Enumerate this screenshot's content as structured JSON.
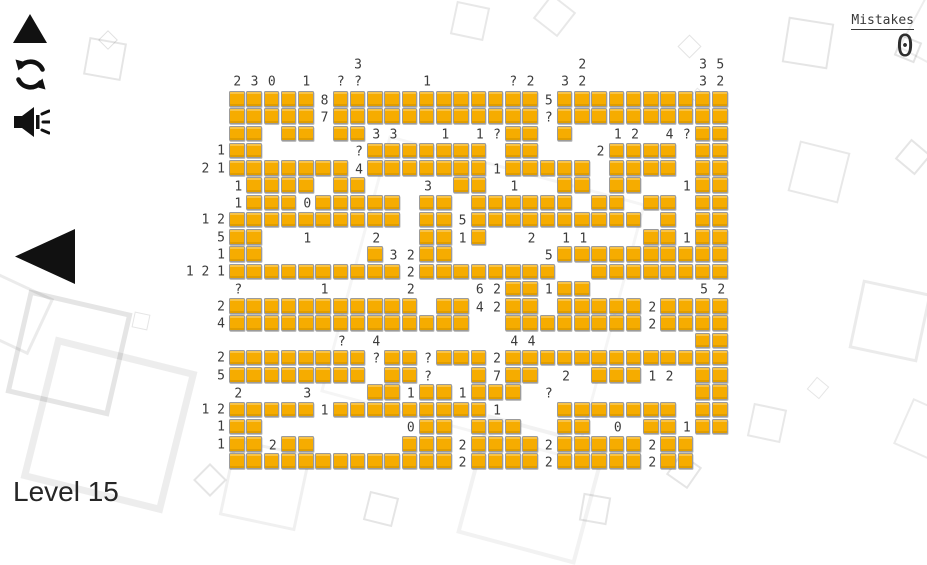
{
  "header": {
    "mistakes_label": "Mistakes",
    "mistakes_value": "0"
  },
  "footer": {
    "level_label": "Level 15"
  },
  "controls": {
    "up_button": "up-triangle",
    "restart_button": "refresh-arrows",
    "sound_button": "speaker-waves",
    "back_button": "left-triangle"
  },
  "colors": {
    "tile_fill": "#F6AC00",
    "tile_border": "#9B9B9B",
    "icon_black": "#111111",
    "label_gray": "#3C3C3C"
  },
  "puzzle": {
    "rows": 22,
    "cols": 29,
    "geometry": {
      "left": 229,
      "top": 91,
      "pitch": 17.25,
      "tile": 15.5
    },
    "grid": [
      "#####.############.##########",
      "#####.############.##########",
      "##.##.##........##.#.......##",
      "##......#######.##....####.##",
      "#######.#######.#####.####.##",
      ".####.##.....##....##.##...##",
      ".###.#####.##.######.##.##.##",
      "##########.##.##########.#.##",
      "##.........##.#.........##.##",
      "##......#..##......##########",
      "##########.########..########",
      "................##.##........",
      "###########.##..##.#####.####",
      "##############..########.####",
      "...........................##",
      "########.##.###.#############",
      "########.##...#.##...###...##",
      "........##.##.###..........##",
      "#####.#########....#######.##",
      "##.........##.###..##...##.##",
      "##.##.....###.####.#####.##..",
      "#############.####.#####.##.."
    ],
    "cell_labels": [
      {
        "r": 0,
        "c": 5,
        "t": "8"
      },
      {
        "r": 0,
        "c": 18,
        "t": "5"
      },
      {
        "r": 1,
        "c": 5,
        "t": "7"
      },
      {
        "r": 1,
        "c": 18,
        "t": "?"
      },
      {
        "r": 2,
        "c": 8,
        "t": "3"
      },
      {
        "r": 2,
        "c": 9,
        "t": "3"
      },
      {
        "r": 2,
        "c": 12,
        "t": "1"
      },
      {
        "r": 2,
        "c": 14,
        "t": "1"
      },
      {
        "r": 2,
        "c": 15,
        "t": "?"
      },
      {
        "r": 2,
        "c": 22,
        "t": "1"
      },
      {
        "r": 2,
        "c": 23,
        "t": "2"
      },
      {
        "r": 2,
        "c": 25,
        "t": "4"
      },
      {
        "r": 2,
        "c": 26,
        "t": "?"
      },
      {
        "r": 3,
        "c": 7,
        "t": "?"
      },
      {
        "r": 3,
        "c": 21,
        "t": "2"
      },
      {
        "r": 4,
        "c": 7,
        "t": "4"
      },
      {
        "r": 4,
        "c": 15,
        "t": "1"
      },
      {
        "r": 5,
        "c": 0,
        "t": "1"
      },
      {
        "r": 5,
        "c": 11,
        "t": "3"
      },
      {
        "r": 5,
        "c": 16,
        "t": "1"
      },
      {
        "r": 5,
        "c": 26,
        "t": "1"
      },
      {
        "r": 6,
        "c": 0,
        "t": "1"
      },
      {
        "r": 6,
        "c": 4,
        "t": "0"
      },
      {
        "r": 7,
        "c": 13,
        "t": "5"
      },
      {
        "r": 8,
        "c": 4,
        "t": "1"
      },
      {
        "r": 8,
        "c": 8,
        "t": "2"
      },
      {
        "r": 8,
        "c": 13,
        "t": "1"
      },
      {
        "r": 8,
        "c": 17,
        "t": "2"
      },
      {
        "r": 8,
        "c": 19,
        "t": "1"
      },
      {
        "r": 8,
        "c": 20,
        "t": "1"
      },
      {
        "r": 8,
        "c": 26,
        "t": "1"
      },
      {
        "r": 9,
        "c": 9,
        "t": "3"
      },
      {
        "r": 9,
        "c": 10,
        "t": "2"
      },
      {
        "r": 9,
        "c": 18,
        "t": "5"
      },
      {
        "r": 10,
        "c": 10,
        "t": "2"
      },
      {
        "r": 11,
        "c": 0,
        "t": "?"
      },
      {
        "r": 11,
        "c": 5,
        "t": "1"
      },
      {
        "r": 11,
        "c": 10,
        "t": "2"
      },
      {
        "r": 11,
        "c": 14,
        "t": "6"
      },
      {
        "r": 11,
        "c": 15,
        "t": "2"
      },
      {
        "r": 11,
        "c": 18,
        "t": "1"
      },
      {
        "r": 11,
        "c": 27,
        "t": "5"
      },
      {
        "r": 11,
        "c": 28,
        "t": "2"
      },
      {
        "r": 12,
        "c": 14,
        "t": "4"
      },
      {
        "r": 12,
        "c": 15,
        "t": "2"
      },
      {
        "r": 12,
        "c": 24,
        "t": "2"
      },
      {
        "r": 13,
        "c": 24,
        "t": "2"
      },
      {
        "r": 14,
        "c": 6,
        "t": "?"
      },
      {
        "r": 14,
        "c": 8,
        "t": "4"
      },
      {
        "r": 14,
        "c": 16,
        "t": "4"
      },
      {
        "r": 14,
        "c": 17,
        "t": "4"
      },
      {
        "r": 15,
        "c": 8,
        "t": "?"
      },
      {
        "r": 15,
        "c": 11,
        "t": "?"
      },
      {
        "r": 15,
        "c": 15,
        "t": "2"
      },
      {
        "r": 16,
        "c": 11,
        "t": "?"
      },
      {
        "r": 16,
        "c": 15,
        "t": "7"
      },
      {
        "r": 16,
        "c": 19,
        "t": "2"
      },
      {
        "r": 16,
        "c": 24,
        "t": "1"
      },
      {
        "r": 16,
        "c": 25,
        "t": "2"
      },
      {
        "r": 17,
        "c": 0,
        "t": "2"
      },
      {
        "r": 17,
        "c": 4,
        "t": "3"
      },
      {
        "r": 17,
        "c": 10,
        "t": "1"
      },
      {
        "r": 17,
        "c": 13,
        "t": "1"
      },
      {
        "r": 17,
        "c": 18,
        "t": "?"
      },
      {
        "r": 18,
        "c": 5,
        "t": "1"
      },
      {
        "r": 18,
        "c": 15,
        "t": "1"
      },
      {
        "r": 19,
        "c": 10,
        "t": "0"
      },
      {
        "r": 19,
        "c": 22,
        "t": "0"
      },
      {
        "r": 19,
        "c": 26,
        "t": "1"
      },
      {
        "r": 20,
        "c": 2,
        "t": "2"
      },
      {
        "r": 20,
        "c": 13,
        "t": "2"
      },
      {
        "r": 20,
        "c": 18,
        "t": "2"
      },
      {
        "r": 20,
        "c": 24,
        "t": "2"
      },
      {
        "r": 21,
        "c": 13,
        "t": "2"
      },
      {
        "r": 21,
        "c": 18,
        "t": "2"
      },
      {
        "r": 21,
        "c": 24,
        "t": "2"
      }
    ],
    "left_labels": [
      {
        "r": 3,
        "t": "1"
      },
      {
        "r": 4,
        "t": "2 1"
      },
      {
        "r": 7,
        "t": "1 2"
      },
      {
        "r": 8,
        "t": "5"
      },
      {
        "r": 9,
        "t": "1"
      },
      {
        "r": 10,
        "t": "1 2 1"
      },
      {
        "r": 12,
        "t": "2"
      },
      {
        "r": 13,
        "t": "4"
      },
      {
        "r": 15,
        "t": "2"
      },
      {
        "r": 16,
        "t": "5"
      },
      {
        "r": 18,
        "t": "1 2"
      },
      {
        "r": 19,
        "t": "1"
      },
      {
        "r": 20,
        "t": "1"
      }
    ],
    "top_labels_lower": [
      {
        "c": 0,
        "t": "2"
      },
      {
        "c": 1,
        "t": "3"
      },
      {
        "c": 2,
        "t": "0"
      },
      {
        "c": 4,
        "t": "1"
      },
      {
        "c": 6,
        "t": "?"
      },
      {
        "c": 7,
        "t": "?"
      },
      {
        "c": 11,
        "t": "1"
      },
      {
        "c": 16,
        "t": "?"
      },
      {
        "c": 17,
        "t": "2"
      },
      {
        "c": 19,
        "t": "3"
      },
      {
        "c": 20,
        "t": "2"
      },
      {
        "c": 27,
        "t": "3"
      },
      {
        "c": 28,
        "t": "2"
      }
    ],
    "top_labels_upper": [
      {
        "c": 7,
        "t": "3"
      },
      {
        "c": 20,
        "t": "2"
      },
      {
        "c": 27,
        "t": "3"
      },
      {
        "c": 28,
        "t": "5"
      }
    ]
  },
  "decor_squares": [
    {
      "x": 86,
      "y": 40,
      "s": 34,
      "rot": 10,
      "w": 2,
      "o": 0.1
    },
    {
      "x": 101,
      "y": 33,
      "s": 12,
      "rot": 45,
      "w": 1.5,
      "o": 0.12
    },
    {
      "x": 453,
      "y": 4,
      "s": 30,
      "rot": 12,
      "w": 2,
      "o": 0.09
    },
    {
      "x": 539,
      "y": 0,
      "s": 27,
      "rot": 38,
      "w": 2,
      "o": 0.09
    },
    {
      "x": 681,
      "y": 38,
      "s": 15,
      "rot": 45,
      "w": 1.5,
      "o": 0.11
    },
    {
      "x": 785,
      "y": 20,
      "s": 42,
      "rot": 9,
      "w": 2.5,
      "o": 0.1
    },
    {
      "x": 897,
      "y": 38,
      "s": 18,
      "rot": 22,
      "w": 2,
      "o": 0.11
    },
    {
      "x": 920,
      "y": -40,
      "s": 120,
      "rot": 28,
      "w": 2,
      "o": 0.07
    },
    {
      "x": 692,
      "y": 90,
      "s": 10,
      "rot": 40,
      "w": 1,
      "o": 0.09
    },
    {
      "x": 793,
      "y": 146,
      "s": 48,
      "rot": 14,
      "w": 2.5,
      "o": 0.09
    },
    {
      "x": 900,
      "y": 144,
      "s": 22,
      "rot": 40,
      "w": 2,
      "o": 0.1
    },
    {
      "x": 855,
      "y": 286,
      "s": 64,
      "rot": 12,
      "w": 3,
      "o": 0.08
    },
    {
      "x": 901,
      "y": 406,
      "s": 46,
      "rot": 24,
      "w": 2.5,
      "o": 0.08
    },
    {
      "x": -18,
      "y": 283,
      "s": 56,
      "rot": 25,
      "w": 3,
      "o": 0.08
    },
    {
      "x": 16,
      "y": 300,
      "s": 96,
      "rot": 13,
      "w": 5,
      "o": 0.1
    },
    {
      "x": 133,
      "y": 313,
      "s": 14,
      "rot": 12,
      "w": 1.5,
      "o": 0.1
    },
    {
      "x": 36,
      "y": 352,
      "s": 132,
      "rot": 14,
      "w": 7,
      "o": 0.07
    },
    {
      "x": 198,
      "y": 468,
      "s": 20,
      "rot": 45,
      "w": 2,
      "o": 0.1
    },
    {
      "x": 226,
      "y": 446,
      "s": 72,
      "rot": 12,
      "w": 3,
      "o": 0.06
    },
    {
      "x": 366,
      "y": 494,
      "s": 26,
      "rot": 14,
      "w": 2,
      "o": 0.1
    },
    {
      "x": 581,
      "y": 495,
      "s": 24,
      "rot": 10,
      "w": 2,
      "o": 0.1
    },
    {
      "x": 671,
      "y": 458,
      "s": 22,
      "rot": 35,
      "w": 2,
      "o": 0.1
    },
    {
      "x": 750,
      "y": 406,
      "s": 30,
      "rot": 12,
      "w": 2,
      "o": 0.09
    },
    {
      "x": 810,
      "y": 380,
      "s": 14,
      "rot": 40,
      "w": 1.5,
      "o": 0.1
    },
    {
      "x": 470,
      "y": 428,
      "s": 115,
      "rot": 15,
      "w": 4,
      "o": 0.05
    },
    {
      "x": 350,
      "y": 165,
      "s": 260,
      "rot": 15,
      "w": 3,
      "o": 0.04
    }
  ]
}
